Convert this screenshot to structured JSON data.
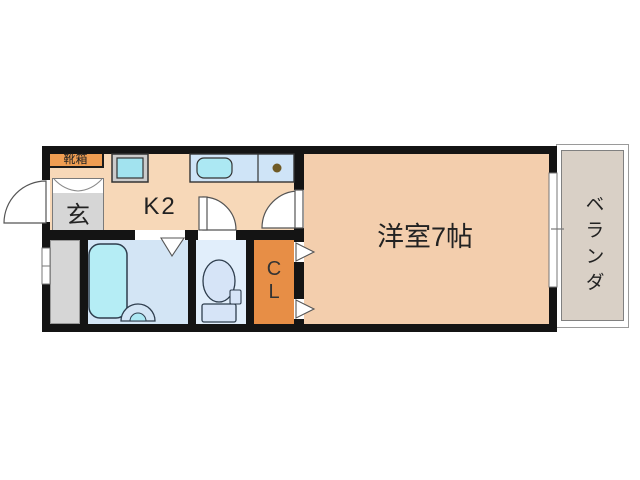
{
  "plan": {
    "type": "apartment-floor-plan",
    "rooms": {
      "shoebox_label": "靴箱",
      "entrance_label": "玄",
      "kitchen_label": "K2",
      "main_room_label": "洋室7帖",
      "closet_line1": "C",
      "closet_line2": "L",
      "veranda_label": "ベランダ"
    },
    "fixtures": [
      "shoe-cabinet",
      "entrance-step",
      "washing-machine-space",
      "kitchen-counter",
      "kitchen-sink",
      "gas-burner",
      "bathtub",
      "wash-basin",
      "toilet",
      "closet-doors",
      "entrance-door-swing",
      "toilet-door-swing",
      "room-door-swing",
      "bathroom-folding-door",
      "sliding-window-left",
      "sliding-window-right",
      "veranda"
    ]
  },
  "colors": {
    "wall": "#141414",
    "kitchen-floor": "#f7d8b8",
    "room-floor": "#f3cead",
    "genkan-gray": "#d6d6d6",
    "closet-orange": "#e78e46",
    "shoebox-orange": "#ef9d52",
    "bath-floor": "#d3e5f5",
    "toilet-floor": "#e1eefb",
    "counter-blue": "#cfe4f7",
    "sink-cyan": "#ace8f3",
    "tub-cyan": "#b5edf5",
    "machine-gray": "#cbcbcb",
    "machine-cyan": "#a2e3ef",
    "veranda-fill": "#d9d0c6",
    "fixture-stroke": "#2e3d4d",
    "door-stroke": "#555555",
    "burner-brown": "#6f5a25",
    "text": "#222222"
  }
}
